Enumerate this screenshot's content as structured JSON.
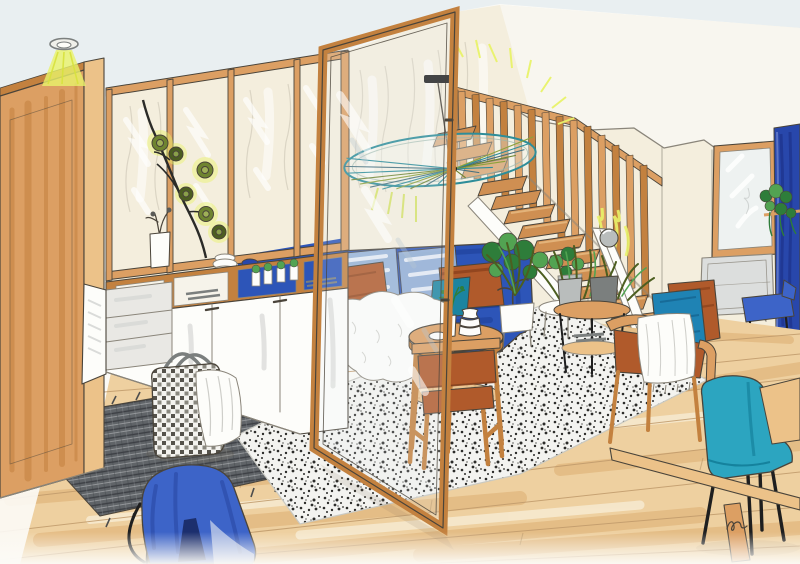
{
  "artwork": {
    "type": "hand-drawn interior design sketch",
    "room": "open-plan living room with glass partition, staircase and slide",
    "signature_note": "small handwritten artist mark, bottom right"
  },
  "palette": {
    "paper": "#fbfaf6",
    "ceiling": "#e9eff1",
    "wallCream": "#f4eedd",
    "wallWhite": "#f8f6ef",
    "wood": "#dc9f63",
    "woodDeep": "#c3813f",
    "woodLight": "#ecc289",
    "tread": "#cf8f52",
    "treadTop": "#e9bd84",
    "floorBase": "#eed0a0",
    "floorStreak": "#d9a767",
    "floorPale": "#f7ecd4",
    "white": "#fdfdfa",
    "cabinetShade": "#d7d8d6",
    "sofaBlue": "#2d55b8",
    "sofaBlueDark": "#1d3f96",
    "cushionRust": "#b05a2b",
    "cushionRustDark": "#8f431d",
    "cushionTeal": "#1b84a0",
    "paleBlue": "#a9c4dd",
    "armchairBlue": "#1f83b4",
    "chairTeal": "#2ca5c0",
    "chairTealDark": "#15829d",
    "curtainBlue": "#2847ab",
    "stoolBlue": "#3d64c8",
    "slotBlue": "#1c2f6e",
    "rugDark": "#606468",
    "rugLine": "#3c3f44",
    "rugLightLine": "#a7aaac",
    "speckleBg": "#f3f3f0",
    "ink": "#4a443a",
    "inkSoft": "#8a857a",
    "green": "#2e7d3a",
    "greenLight": "#52a352",
    "olive": "#6f8430",
    "leafDark": "#4c5e20",
    "glow": "#e9f36a",
    "glowDeep": "#cfe04e",
    "lampTeal": "#2e8d99",
    "lampOlive": "#8da23c",
    "gray": "#b9bdbc",
    "grayDark": "#7b7f7e",
    "radiator": "#dcdedd",
    "black": "#1f1f1f",
    "shadow": "#8a7a5e"
  },
  "objects": [
    {
      "id": "ceiling-spotlight",
      "label": "recessed ceiling spot with yellow light beam"
    },
    {
      "id": "left-wardrobe",
      "label": "tall wooden wardrobe panel"
    },
    {
      "id": "glass-partition",
      "label": "wood-framed interior glass partition"
    },
    {
      "id": "pivot-glass-door",
      "label": "open pivoting glass door"
    },
    {
      "id": "branch-decoration",
      "label": "sprig with round green leaves behind glass"
    },
    {
      "id": "sideboard",
      "label": "white sideboard with oak niches, one door open"
    },
    {
      "id": "storage-basket",
      "label": "woven basket with white throw"
    },
    {
      "id": "dark-rug",
      "label": "charcoal woven rug with fringe"
    },
    {
      "id": "wood-floor",
      "label": "light oak plank floor"
    },
    {
      "id": "speckled-rug",
      "label": "black-and-white speckled area rug"
    },
    {
      "id": "blue-sofa",
      "label": "royal-blue sofa with rust and teal cushions"
    },
    {
      "id": "sheepskin-throw",
      "label": "white sheepskin on sofa seat"
    },
    {
      "id": "coffee-table",
      "label": "round two-tier wooden coffee table with vases"
    },
    {
      "id": "dining-chair",
      "label": "cognac leather and wood chair"
    },
    {
      "id": "potted-plants",
      "label": "green plants behind sofa"
    },
    {
      "id": "plant-stand",
      "label": "round plant stand with potted plants"
    },
    {
      "id": "staircase",
      "label": "open wooden staircase with slat balustrade"
    },
    {
      "id": "slide",
      "label": "white slide beside the stairs"
    },
    {
      "id": "pendant-lamp",
      "label": "large fan-ribbed pendant lamp"
    },
    {
      "id": "wall-mirror",
      "label": "wood-framed mirror on right wall"
    },
    {
      "id": "radiator",
      "label": "wall radiator below mirror"
    },
    {
      "id": "blue-curtain",
      "label": "cobalt curtain panel at right edge"
    },
    {
      "id": "hanging-plant",
      "label": "trailing plant on wall shelf"
    },
    {
      "id": "blue-side-chair",
      "label": "small blue chair by the radiator"
    },
    {
      "id": "teal-chair",
      "label": "teal shell chair at wooden table"
    },
    {
      "id": "wood-table",
      "label": "light wood table, bottom right"
    },
    {
      "id": "blue-stool",
      "label": "blue upholstered stool, foreground"
    },
    {
      "id": "artist-signature",
      "label": "small handwritten signature"
    }
  ]
}
